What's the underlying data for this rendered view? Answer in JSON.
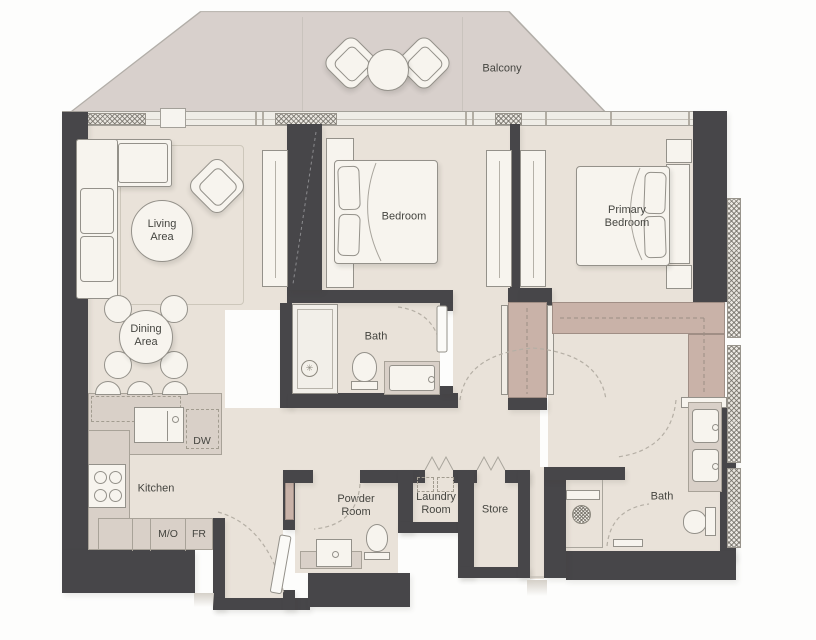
{
  "plan": {
    "type": "apartment-floorplan-2br",
    "rooms": {
      "balcony": "Balcony",
      "living_area": "Living Area",
      "dining_area": "Dining Area",
      "kitchen": "Kitchen",
      "bedroom": "Bedroom",
      "primary_bedroom": "Primary Bedroom",
      "bathroom": "Bath",
      "ensuite_bathroom": "Bath",
      "powder_room": "Powder Room",
      "laundry_room": "Laundry Room",
      "store": "Store"
    },
    "appliances": {
      "dishwasher": "DW",
      "microwave_oven": "M/O",
      "fridge": "FR"
    }
  },
  "colors": {
    "wall": "#474649",
    "floor": "#e9e2d9",
    "balcony": "#d8d0cc",
    "counter": "#d9d0c8",
    "closet": "#c9b2a8",
    "furn": "#f7f4ee",
    "line": "#94918a",
    "label": "#454540",
    "arc": "#b5afa5",
    "band": "#efede7",
    "rug": "#cdc7bb"
  }
}
